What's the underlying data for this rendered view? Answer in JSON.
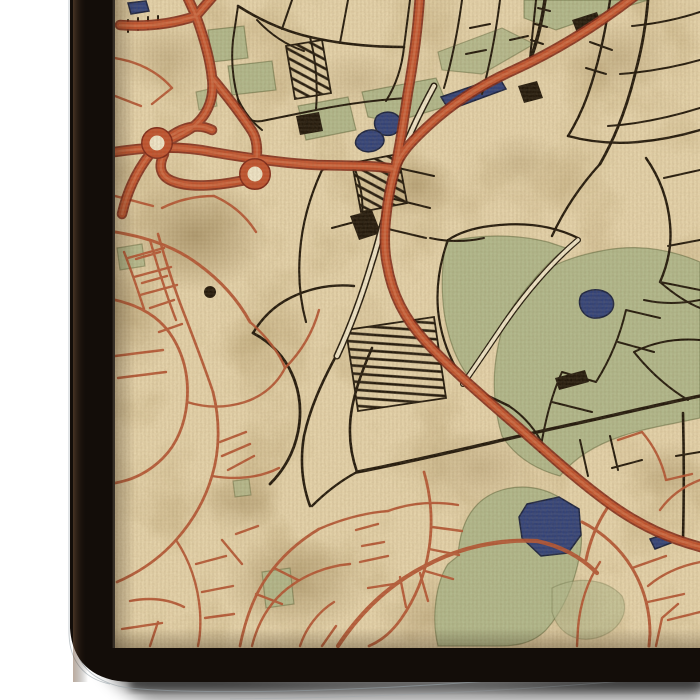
{
  "palette": {
    "background": "#ffffff",
    "parchment": "#e8d6ae",
    "parchment_light": "#f3e9cd",
    "stain_brown": "#6a5124",
    "park_green": "#b2ba8e",
    "park_edge": "rgba(70,82,40,0.45)",
    "water_blue": "#2c3e7a",
    "water_edge": "#141d3e",
    "road_red": "#c14f2b",
    "road_red_dark": "#7e2414",
    "road_red_light": "#da7a52",
    "street_red": "#b5502f",
    "street_black": "#1b1207",
    "canvas_edge": "#130d09",
    "shadow": "#000000",
    "contour_gray": "#97a2a8"
  },
  "map": {
    "parks": [
      {
        "d": "M497,352 C502,322 512,300 528,284 C546,266 572,256 606,250 C640,244 672,250 700,262 L700,418 C672,424 646,428 622,436 C598,444 576,456 560,476 C538,470 516,458 502,436 C494,410 492,380 497,352 Z",
        "o": 1
      },
      {
        "d": "M446,242 C480,234 516,234 548,242 L566,248 C548,262 526,286 508,314 C494,336 480,360 468,376 C456,360 448,338 444,312 C441,288 442,262 446,242 Z",
        "o": 1
      },
      {
        "d": "M298,106 L348,97 L356,130 L306,140 Z",
        "o": 1
      },
      {
        "d": "M362,92 L436,78 L448,106 L394,122 L368,117 Z",
        "o": 1
      },
      {
        "d": "M524,0 L648,0 L602,14 L556,30 L524,18 Z",
        "o": 1
      },
      {
        "d": "M438,52 L502,28 L534,44 L482,74 L442,70 Z",
        "o": 0.9
      },
      {
        "d": "M208,30 L244,26 L248,58 L212,62 Z",
        "o": 1
      },
      {
        "d": "M228,66 L272,61 L276,90 L232,95 Z",
        "o": 1
      },
      {
        "d": "M117,248 L142,244 L145,266 L120,270 Z",
        "o": 0.9
      },
      {
        "d": "M458,556 C460,524 472,502 496,492 C522,482 548,488 566,502 C580,514 584,532 580,554 C574,586 562,612 546,630 C532,644 515,646 498,646 L438,646 C431,618 436,582 448,564 Z",
        "o": 1
      },
      {
        "d": "M262,572 L290,568 L294,604 L266,608 Z",
        "o": 0.9
      },
      {
        "d": "M233,481 L249,479 L251,495 L235,497 Z",
        "o": 0.85
      },
      {
        "d": "M552,588 C576,576 606,578 622,596 C630,614 618,632 596,638 C574,643 558,632 552,612 Z",
        "o": 0.6
      },
      {
        "d": "M196,92 L214,88 L217,106 L199,110 Z",
        "o": 0.85
      }
    ],
    "water": [
      {
        "d": "M377,116 C386,109 398,112 401,121 C403,130 394,137 384,135 C375,133 372,123 377,116 Z"
      },
      {
        "d": "M359,135 C370,126 383,130 384,140 C384,149 370,155 361,150 C354,146 354,141 359,135 Z"
      },
      {
        "d": "M441,97 L499,77 L506,89 L449,110 Z"
      },
      {
        "d": "M582,294 C594,286 609,290 613,300 C616,311 606,319 593,318 C581,316 576,302 582,294 Z"
      },
      {
        "d": "M527,504 L559,497 L579,509 L581,535 L568,553 L541,556 L522,538 L519,517 Z"
      },
      {
        "d": "M650,539 L666,534 L671,543 L655,549 Z"
      },
      {
        "d": "M128,3 L146,1 L149,11 L131,14 Z"
      }
    ],
    "stains": [
      {
        "cx": 195,
        "cy": 235,
        "rx": 75,
        "ry": 58,
        "o": 0.55
      },
      {
        "cx": 168,
        "cy": 58,
        "rx": 52,
        "ry": 38,
        "o": 0.3
      },
      {
        "cx": 415,
        "cy": 185,
        "rx": 45,
        "ry": 32,
        "o": 0.3
      },
      {
        "cx": 618,
        "cy": 58,
        "rx": 58,
        "ry": 40,
        "o": 0.3
      },
      {
        "cx": 480,
        "cy": 468,
        "rx": 62,
        "ry": 40,
        "o": 0.28
      },
      {
        "cx": 295,
        "cy": 585,
        "rx": 75,
        "ry": 48,
        "o": 0.4
      },
      {
        "cx": 558,
        "cy": 602,
        "rx": 50,
        "ry": 34,
        "o": 0.3
      },
      {
        "cx": 658,
        "cy": 352,
        "rx": 45,
        "ry": 62,
        "o": 0.22
      },
      {
        "cx": 358,
        "cy": 80,
        "rx": 48,
        "ry": 30,
        "o": 0.22
      },
      {
        "cx": 242,
        "cy": 502,
        "rx": 42,
        "ry": 30,
        "o": 0.3
      },
      {
        "cx": 135,
        "cy": 320,
        "rx": 40,
        "ry": 55,
        "o": 0.25
      },
      {
        "cx": 430,
        "cy": 620,
        "rx": 55,
        "ry": 30,
        "o": 0.3
      },
      {
        "cx": 670,
        "cy": 470,
        "rx": 40,
        "ry": 30,
        "o": 0.25
      },
      {
        "cx": 520,
        "cy": 160,
        "rx": 40,
        "ry": 28,
        "o": 0.2
      }
    ],
    "hatch_blocks": [
      {
        "d": "M346,330 L434,317 L446,398 L358,411 Z",
        "p": "url(#hatchA)"
      },
      {
        "d": "M352,163 L398,154 L407,203 L361,212 Z",
        "p": "url(#hatchB)"
      },
      {
        "d": "M286,46 L322,40 L331,93 L295,99 Z",
        "p": "url(#hatchB)"
      }
    ],
    "avenues": [
      {
        "d": "M434,86 C420,112 406,140 398,166 C389,196 382,232 372,262 C362,296 349,330 337,356",
        "cw": 7,
        "fw": 4
      },
      {
        "d": "M578,240 C552,262 524,294 500,330 C485,352 473,370 463,384",
        "cw": 6,
        "fw": 3.5
      }
    ],
    "black_roads": [
      {
        "d": "M336,356 C322,382 310,408 304,436 C300,460 302,484 310,506",
        "w": 2.6
      },
      {
        "d": "M357,472 C430,458 500,440 560,427 C612,416 660,404 700,396",
        "w": 3.4
      },
      {
        "d": "M357,472 C350,452 348,430 352,408 C356,386 364,366 372,348",
        "w": 2.6
      },
      {
        "d": "M357,472 C342,480 326,492 312,506",
        "w": 2.4
      },
      {
        "d": "M253,333 C270,342 284,356 292,374 C300,392 302,412 298,432 C294,452 284,470 270,484",
        "w": 2.8
      },
      {
        "d": "M253,333 C262,318 274,306 290,298 C310,288 332,284 354,286",
        "w": 2.4
      },
      {
        "d": "M238,6 C260,20 284,31 310,37 C340,44 372,47 404,47",
        "w": 2.6
      },
      {
        "d": "M404,47 L410,0 M340,43 L348,0 M282,29 L292,0"
      },
      {
        "d": "M310,37 C316,60 318,85 316,110 M316,110 L262,121 C250,123 241,117 238,99 M238,6 L233,40 C231,60 233,81 238,99"
      },
      {
        "d": "M404,47 C402,67 396,85 386,101"
      },
      {
        "d": "M462,0 C458,30 452,60 444,88 M500,0 C496,32 490,64 482,94 M536,0 L530,58"
      },
      {
        "d": "M610,0 C606,28 600,56 592,82 C586,102 578,120 568,136",
        "w": 2.4
      },
      {
        "d": "M648,0 C646,24 642,48 636,70 C628,104 616,136 600,164",
        "w": 2.8
      },
      {
        "d": "M700,12 C676,20 654,24 632,26 M700,60 C672,68 646,72 620,74 M700,108 C668,118 638,124 608,126"
      },
      {
        "d": "M568,136 C590,142 614,144 638,142 C660,140 680,136 700,130",
        "w": 2.4
      },
      {
        "d": "M600,164 C580,186 564,210 552,236",
        "w": 2.4
      },
      {
        "d": "M646,158 C660,178 668,200 670,224 C672,244 668,264 660,282",
        "w": 2.4
      },
      {
        "d": "M700,170 L664,178 M700,240 L668,246"
      },
      {
        "d": "M700,300 C680,304 662,304 644,300 M660,282 L700,290"
      },
      {
        "d": "M540,452 C545,420 552,394 562,372 M562,372 L596,382 M552,402 L592,412"
      },
      {
        "d": "M596,382 C610,360 620,336 626,310 M626,310 L660,318 M618,342 L654,352"
      },
      {
        "d": "M660,282 C676,296 690,304 700,308"
      },
      {
        "d": "M700,340 C676,338 654,342 634,352 M634,352 C650,372 668,388 688,400"
      },
      {
        "d": "M448,240 C440,262 436,286 438,310 C440,330 446,350 456,368",
        "w": 2.2
      },
      {
        "d": "M448,240 C460,232 474,228 490,226 C520,222 550,224 578,238",
        "w": 2.2
      },
      {
        "d": "M352,162 C360,180 364,200 362,220 M362,220 L332,228 M352,162 L322,170"
      },
      {
        "d": "M398,168 L434,176 M390,198 L430,208 M384,228 L426,238"
      },
      {
        "d": "M430,238 C448,242 466,242 484,238"
      },
      {
        "d": "M322,170 C310,196 302,224 300,252 C298,276 300,300 306,322",
        "w": 2.2
      },
      {
        "d": "M580,440 L588,476 M610,436 L618,470 M612,468 L642,460"
      },
      {
        "d": "M683,413 C684,455 684,498 683,540",
        "w": 2.6
      },
      {
        "d": "M700,452 L676,456"
      },
      {
        "d": "M257,20 C270,34 286,45 304,51"
      },
      {
        "d": "M128,20 L128,32 M138,18 L138,30 M148,17 L148,29 M158,16 L158,28"
      },
      {
        "d": "M470,28 L490,24 M466,54 L486,50 M510,40 L528,36 M590,42 L612,50 M586,68 L606,74"
      },
      {
        "d": "M545,0 C542,20 538,38 532,55",
        "w": 3.5
      },
      {
        "d": "M538,8 L550,11 M535,24 L547,27 M531,40 L543,44"
      },
      {
        "d": "M462,384 C477,391 493,398 509,406",
        "w": 2.4
      },
      {
        "d": "M509,406 C524,416 536,430 544,447"
      },
      {
        "d": "M316,110 C346,104 376,100 406,98"
      },
      {
        "d": "M238,99 C244,112 252,122 262,130"
      }
    ],
    "black_fills": [
      {
        "d": "M350,216 L372,210 L381,233 L359,240 Z"
      },
      {
        "d": "M518,86 L537,81 L543,98 L524,103 Z"
      },
      {
        "d": "M296,116 L319,112 L323,131 L300,135 Z"
      },
      {
        "d": "M572,20 L597,12 L602,25 L577,33 Z"
      },
      {
        "d": "M204,292 a6,6 0 1,0 12,0 a6,6 0 1,0 -12,0"
      },
      {
        "d": "M555,378 L585,370 L589,382 L559,390 Z"
      }
    ],
    "red_streets": [
      {
        "d": "M115,232 C152,238 178,249 198,264 C220,280 238,300 250,322",
        "w": 3
      },
      {
        "d": "M158,234 C166,262 175,291 185,316 C195,342 205,368 213,392",
        "w": 2.6
      },
      {
        "d": "M150,240 C158,268 166,294 176,320"
      },
      {
        "d": "M160,252 L136,259 M167,276 L142,283 M174,300 L150,308 M182,324 L159,332"
      },
      {
        "d": "M115,300 C142,306 161,318 173,338 C185,358 189,380 187,402 C185,424 177,444 163,458 C149,472 133,480 115,483",
        "w": 2.8
      },
      {
        "d": "M187,402 C206,408 226,408 245,402 C263,396 277,384 285,368"
      },
      {
        "d": "M213,392 C220,420 220,450 212,476 C205,500 192,522 176,540 C160,558 140,572 117,582",
        "w": 2.8
      },
      {
        "d": "M212,476 C236,480 259,478 279,468"
      },
      {
        "d": "M176,540 C190,561 198,586 200,611 C201,626 200,637 198,646"
      },
      {
        "d": "M196,564 L226,556 M202,592 L233,586 M205,618 L234,614"
      },
      {
        "d": "M240,646 C245,621 253,597 267,577 C281,557 299,541 319,529",
        "w": 2.8
      },
      {
        "d": "M256,594 L282,604 M274,568 L298,580"
      },
      {
        "d": "M319,529 C342,519 364,513 388,511"
      },
      {
        "d": "M285,368 C301,352 313,332 319,310"
      },
      {
        "d": "M124,252 C132,272 138,291 144,309 M128,258 L164,248 M134,277 L171,267 M140,295 L177,285"
      },
      {
        "d": "M115,356 L163,350 M118,378 L166,372"
      },
      {
        "d": "M130,601 C150,597 168,599 184,607 M122,629 L162,623 M150,646 L158,622"
      },
      {
        "d": "M222,540 L242,564 M236,534 L258,526"
      },
      {
        "d": "M252,646 C258,622 270,602 288,588 C306,574 328,566 350,564"
      },
      {
        "d": "M300,646 C306,628 318,612 334,602 M322,646 L336,626"
      },
      {
        "d": "M338,646 C361,611 391,583 427,565 C461,547 499,539 537,541",
        "w": 4.2
      },
      {
        "d": "M537,541 C561,546 581,557 597,573",
        "w": 4.2
      },
      {
        "d": "M388,511 C410,503 434,501 458,505"
      },
      {
        "d": "M424,472 C431,496 433,523 429,549 C425,575 415,599 401,619 C391,633 381,641 369,646",
        "w": 2.8
      },
      {
        "d": "M429,549 L459,555 M425,571 L453,579 M432,527 L462,531"
      },
      {
        "d": "M582,522 C602,532 620,548 632,568 C644,588 650,610 650,634 L649,646",
        "w": 3
      },
      {
        "d": "M632,568 L666,556 M648,602 L684,594"
      },
      {
        "d": "M700,562 C680,566 662,574 648,586"
      },
      {
        "d": "M600,562 C587,582 580,604 578,628 L577,646"
      },
      {
        "d": "M610,504 C598,521 590,540 586,560",
        "w": 3
      },
      {
        "d": "M642,432 C654,446 662,462 666,480 M666,480 L692,474 M642,432 L618,440"
      },
      {
        "d": "M360,562 L388,556 M368,588 L394,584 M400,577 L406,607 M420,573 L428,601"
      },
      {
        "d": "M656,646 L662,618 L678,604 M700,612 L668,620"
      },
      {
        "d": "M115,58 C138,62 158,72 172,88 M172,88 L152,104 M115,96 L141,106"
      },
      {
        "d": "M162,208 C178,200 196,196 214,196 M115,196 L153,206"
      },
      {
        "d": "M246,432 L220,442 M250,444 L222,456 M254,456 L228,470"
      },
      {
        "d": "M250,322 C267,337 280,354 285,368"
      },
      {
        "d": "M214,196 C232,204 246,216 256,232"
      },
      {
        "d": "M356,530 L378,524 M362,546 L384,542"
      },
      {
        "d": "M700,480 C684,486 670,496 660,510"
      }
    ],
    "red_major": [
      {
        "d": "M640,-8 C602,22 562,48 514,70 C478,86 448,107 426,128 C410,143 399,155 395,169 C386,202 382,240 387,264 C392,294 404,318 426,342 C450,368 480,394 510,420 C540,446 574,478 610,504 C642,527 670,539 704,548"
      },
      {
        "d": "M108,153 C152,146 182,146 212,152 C247,158 282,163 317,165 C347,166 372,165 395,169"
      },
      {
        "d": "M196,16 L185,-8 M196,16 L215,-6 M196,16 C172,24 146,27 120,25 M196,16 C204,38 210,58 212,78"
      },
      {
        "d": "M212,78 C215,100 206,118 190,129 C176,138 162,142 152,152"
      },
      {
        "d": "M212,78 C227,96 241,114 252,131 C257,139 258,150 256,163"
      },
      {
        "d": "M150,154 C136,172 127,192 122,214"
      },
      {
        "d": "M420,-6 C418,28 414,58 408,92 C404,118 400,146 395,169"
      },
      {
        "d": "M160,146 C176,128 196,122 212,130"
      },
      {
        "d": "M164,154 C158,166 160,176 172,181 C192,189 220,185 246,180"
      }
    ],
    "roundabouts": [
      {
        "cx": 157,
        "cy": 143,
        "r": 11
      },
      {
        "cx": 255,
        "cy": 174,
        "r": 11
      }
    ]
  }
}
